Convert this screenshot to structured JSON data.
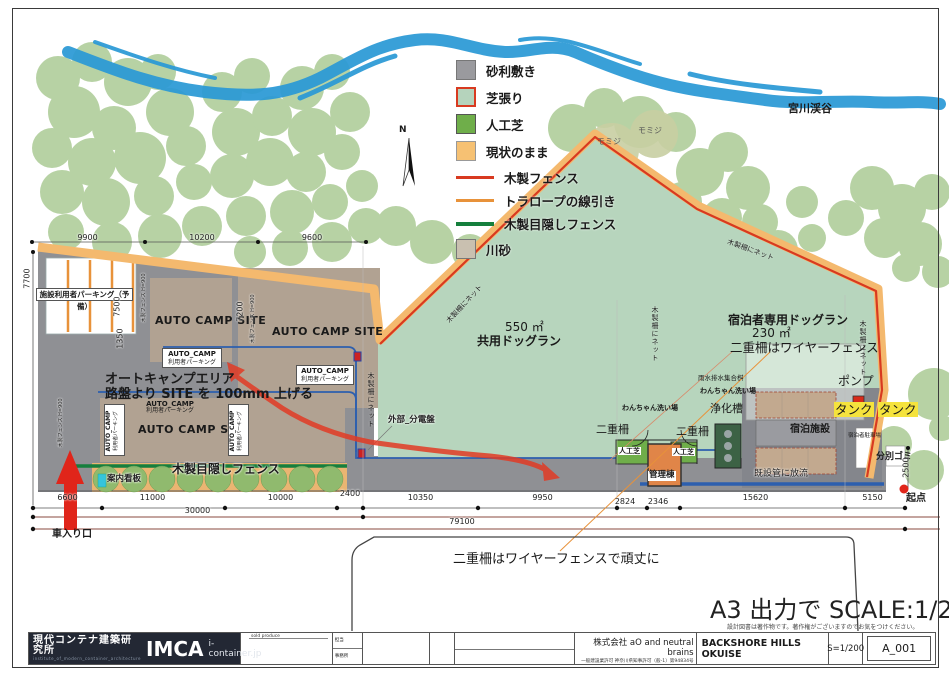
{
  "river": {
    "label": "宮川渓谷"
  },
  "compass": {
    "n": "N"
  },
  "legend": {
    "items": [
      {
        "label": "砂利敷き"
      },
      {
        "label": "芝張り"
      },
      {
        "label": "人工芝"
      },
      {
        "label": "現状のまま"
      },
      {
        "label": "木製フェンス"
      },
      {
        "label": "トラロープの線引き"
      },
      {
        "label": "木製目隠しフェンス"
      },
      {
        "label": "川砂"
      }
    ]
  },
  "labels": {
    "momiji": "モミジ",
    "net": "木製柵にネット",
    "shared_dogrun_area": "550 ㎡",
    "shared_dogrun": "共用ドッグラン",
    "guest_dogrun": "宿泊者専用ドッグラン",
    "guest_dogrun_area": "230 ㎡",
    "double_fence_wire": "二重柵はワイヤーフェンス",
    "pump": "ポンプ",
    "tank": "タンク",
    "rainwater": "雨水排水集合桝",
    "dog_wash": "わんちゃん洗い場",
    "septic": "浄化槽",
    "double_fence": "二重柵",
    "turf": "人工芝",
    "admin": "管理棟",
    "lodging": "宿泊施設",
    "guest_parking": "宿泊者駐車場",
    "waste": "分別ゴミ",
    "discharge": "既設管に放流",
    "origin": "起点",
    "dist_board": "外部_分電盤",
    "reserve_parking": "施設利用者パーキング（予備）",
    "auto_camp_site": "AUTO CAMP SITE",
    "auto_camp": "AUTO_CAMP",
    "user_parking": "利用者パーキング",
    "area_note1": "オートキャンプエリア",
    "area_note2": "路盤より SITE を 100mm 上げる",
    "privacy_fence": "木製目隠しフェンス",
    "info_sign": "案内看板",
    "entrance": "車入り口",
    "wood_fence_h": "木製フェンス H=900",
    "sturdy_note": "二重柵はワイヤーフェンスで頑丈に"
  },
  "dimensions": {
    "top": [
      "9900",
      "10200",
      "9600"
    ],
    "left": [
      "7700",
      "7500",
      "1350",
      "7200"
    ],
    "right": [
      "2500"
    ],
    "bottom": [
      "6600",
      "11000",
      "10000",
      "2400",
      "10350",
      "9950",
      "2824",
      "2346",
      "15620",
      "5150"
    ],
    "totals": [
      "30000",
      "79100"
    ]
  },
  "scale_note": "A3 出力で SCALE:1/200",
  "copyright": "設計図書は著作物です。著作権がございますのでお気をつけください。",
  "titleblock": {
    "office": "現代コンテナ建築研究所",
    "office_sub": "institute_of_modern_container_architecture",
    "office_logo": "IMCA",
    "office_url": "i-container.jp",
    "produce_label": "sold produce",
    "staff_label": "担当",
    "office_label": "事務所",
    "company": "株式会社 aO and neutral brains",
    "license": "一般建設業許可 神奈川県知事許可（般-1）第94834号",
    "project": "BACKSHORE HILLS OKUISE",
    "scale": "S=1/200",
    "sheet": "A_001"
  }
}
